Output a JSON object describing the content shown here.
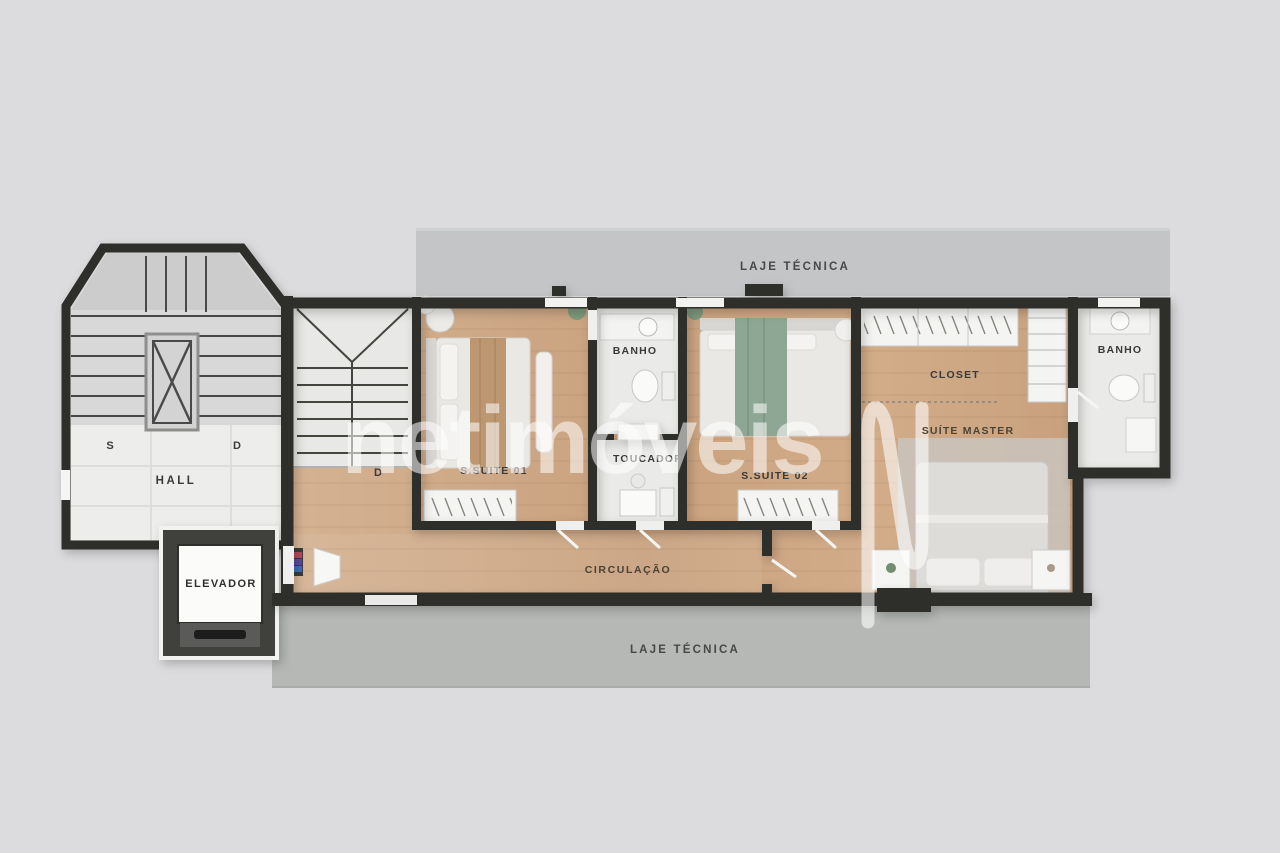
{
  "watermark": {
    "brand": "netimóveis"
  },
  "areas": {
    "laje_top": {
      "label": "LAJE TÉCNICA"
    },
    "laje_bottom": {
      "label": "LAJE TÉCNICA"
    },
    "hall": {
      "label": "HALL"
    },
    "stair_up": {
      "label": "S"
    },
    "stair_down_hall": {
      "label": "D"
    },
    "stair_down_unit": {
      "label": "D"
    },
    "elevador": {
      "label": "ELEVADOR"
    },
    "circulacao": {
      "label": "CIRCULAÇÃO"
    },
    "suite01": {
      "label": "S.SUITE 01"
    },
    "banho1": {
      "label": "BANHO"
    },
    "toucador": {
      "label": "TOUCADOR"
    },
    "suite02": {
      "label": "S.SUITE 02"
    },
    "closet": {
      "label": "CLOSET"
    },
    "suite_master": {
      "label": "SUÍTE MASTER"
    },
    "banho2": {
      "label": "BANHO"
    }
  },
  "colors": {
    "background": "#dcdcde",
    "wall": "#2e2d2c",
    "wood_floor": "#cda887",
    "laje_top_band": "#c4c5c7",
    "laje_bottom_band": "#b5b8b5",
    "room_white": "#eaeae8",
    "stair_gray": "#d7d8d7",
    "accent_green": "#8ea694",
    "watermark": "rgba(255,255,255,0.55)",
    "label_text": "#3a3a38"
  }
}
